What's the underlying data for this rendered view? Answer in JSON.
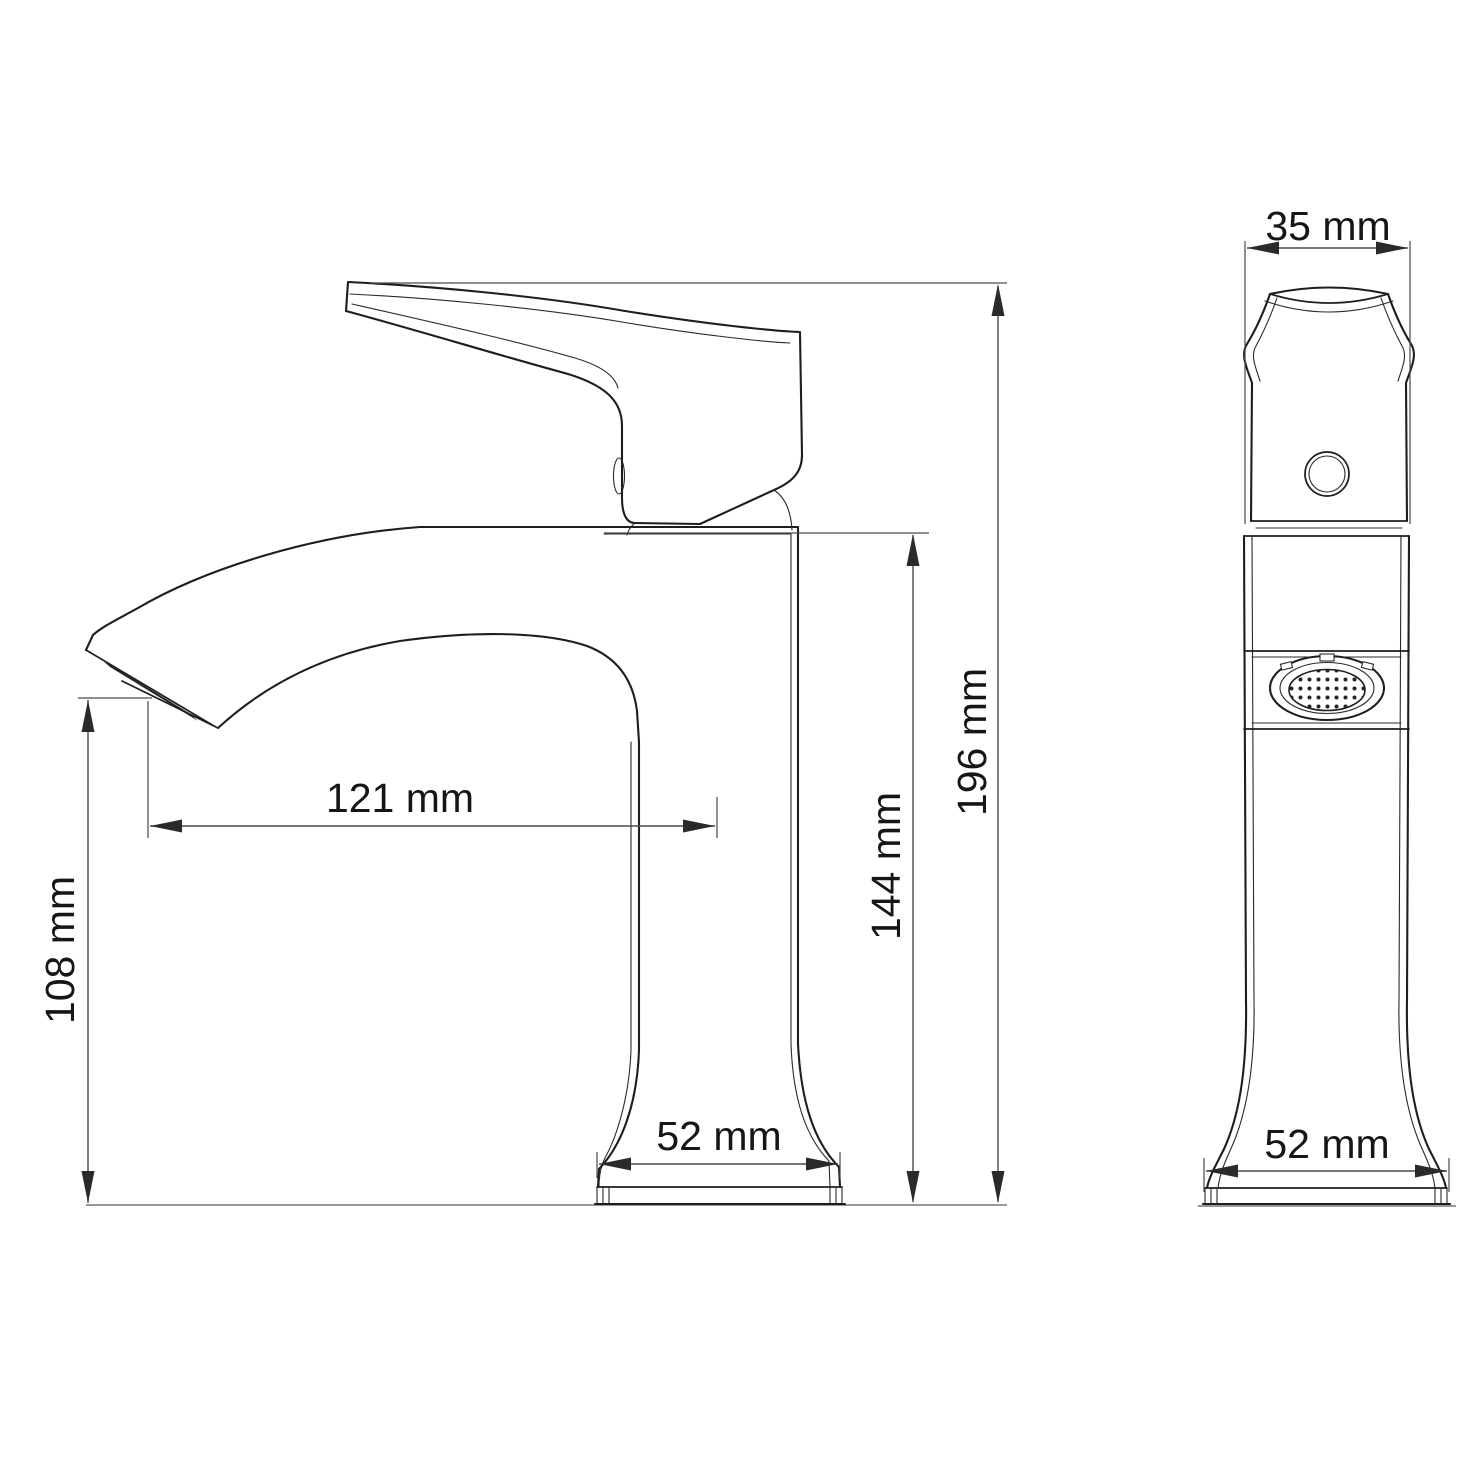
{
  "drawing": {
    "type": "technical-dimension-drawing",
    "subject": "single-lever basin faucet, side view and front view",
    "colors": {
      "background": "#ffffff",
      "outline": "#1e1e1e",
      "inner": "#2a2a2a",
      "dimension": "#4a4a4a",
      "text": "#161616",
      "ground": "#8a8a8a",
      "aerator_fill": "#262626"
    },
    "dimensions": {
      "handle_width_front": {
        "label": "35 mm",
        "value": 35,
        "unit": "mm",
        "orientation": "horizontal",
        "view": "front"
      },
      "overall_height": {
        "label": "196 mm",
        "value": 196,
        "unit": "mm",
        "orientation": "vertical",
        "view": "side"
      },
      "body_top_height": {
        "label": "144 mm",
        "value": 144,
        "unit": "mm",
        "orientation": "vertical",
        "view": "side"
      },
      "spout_reach": {
        "label": "121 mm",
        "value": 121,
        "unit": "mm",
        "orientation": "horizontal",
        "view": "side"
      },
      "outlet_height": {
        "label": "108 mm",
        "value": 108,
        "unit": "mm",
        "orientation": "vertical",
        "view": "side"
      },
      "base_width_side": {
        "label": "52 mm",
        "value": 52,
        "unit": "mm",
        "orientation": "horizontal",
        "view": "side"
      },
      "base_width_front": {
        "label": "52 mm",
        "value": 52,
        "unit": "mm",
        "orientation": "horizontal",
        "view": "front"
      }
    }
  }
}
